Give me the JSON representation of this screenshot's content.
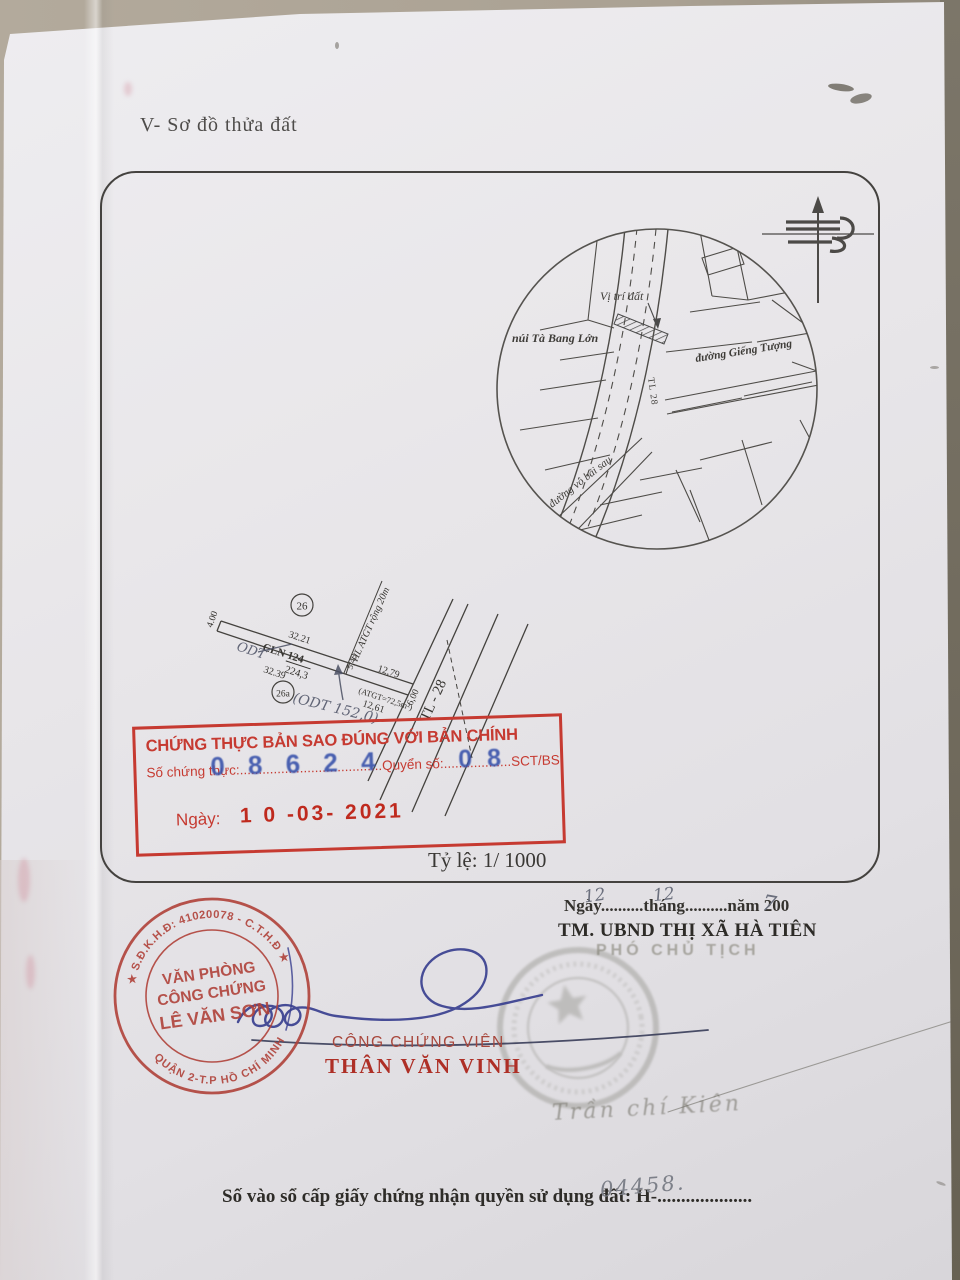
{
  "page": {
    "title": "V- Sơ đồ thửa đất",
    "scale_label": "Tỷ lệ: 1/ 1000"
  },
  "icons": {
    "north": "north-arrow",
    "star": "★"
  },
  "inset_map": {
    "location_label": "Vị trí đất",
    "mountain_label": "núi Tà Bang Lớn",
    "road_right": "đường Giếng Tượng",
    "road_bottom": "đường vô bãi sau",
    "highway_vertical": "TL 28"
  },
  "parcel_diagram": {
    "lot_badge": "26",
    "lot_badge_sub": "26a",
    "edge_left": "4.00",
    "edge_top": "32.21",
    "type_and_number": "CLN 124",
    "area": "224,3",
    "edge_bottom": "32.39",
    "handwritten_overlay": "ODT",
    "handwritten_note": "(ODT 152,0)",
    "divider_width": "5,43",
    "corridor_label": "HL ATGT rộng 20m",
    "segment_top": "12,79",
    "corridor_area": "(ATGT=72,5m²)",
    "segment_bottom": "12,61",
    "road_width": "6,00",
    "road_name": "TL - 28"
  },
  "cert_stamp": {
    "title": "CHỨNG THỰC BẢN SAO ĐÚNG VỚI BẢN CHÍNH",
    "field_so": "Số chứng thực:",
    "dots1": "......................................",
    "field_quyen": "Quyển số:",
    "dots2": "..................",
    "suffix": "SCT/BS",
    "number_blue": "0 8 6 2 4",
    "book_blue": "0 8",
    "date_label": "Ngày:",
    "date_value": "1 0 -03- 2021"
  },
  "approval": {
    "date_prefix": "Ngày",
    "dots1": "..........",
    "day": "12",
    "month_label": "tháng",
    "dots2": "..........",
    "month": "12",
    "year_label": "năm 200",
    "year_digit": "7",
    "authority": "TM. UBND THỊ XÃ HÀ TIÊN",
    "position": "PHÓ CHỦ TỊCH",
    "faded_signature_name": "Trần chí Kiên"
  },
  "notary": {
    "ring_top": "★ S.Đ.K.H.Đ: 41020078 - C.T.H.Đ ★",
    "ring_bottom": "QUẬN 2-T.P HỒ CHÍ MINH",
    "line1": "VĂN PHÒNG",
    "line2": "CÔNG CHỨNG",
    "line3": "LÊ VĂN SƠN",
    "title": "CÔNG CHỨNG VIÊN",
    "name": "THÂN VĂN VINH"
  },
  "registry": {
    "label": "Số vào sổ cấp giấy chứng nhận quyền sử dụng đất:  H-",
    "dots": "....................",
    "number": "04458."
  },
  "colors": {
    "stamp_red": "#c63a31",
    "ink_blue": "#3c55ac",
    "signature_blue": "#383f8f",
    "name_red": "#ae2f26",
    "seal_faded": "#8f8f87"
  }
}
